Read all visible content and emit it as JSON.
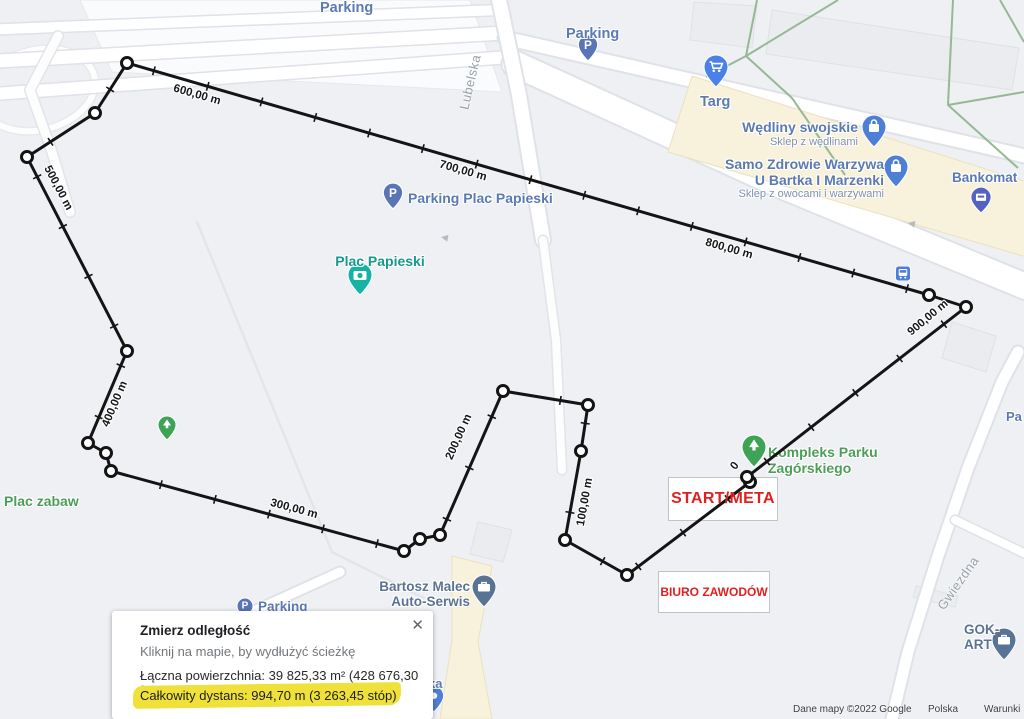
{
  "map": {
    "street_labels": [
      {
        "text": "Lubelska"
      },
      {
        "text": "Gwiezdna"
      },
      {
        "text": "Pa"
      }
    ],
    "places": [
      {
        "lines": [
          "Parking"
        ],
        "type": "parking-area"
      },
      {
        "lines": [
          "Parking"
        ],
        "type": "parking"
      },
      {
        "lines": [
          "Targ"
        ],
        "type": "market"
      },
      {
        "lines": [
          "Wędliny swojskie"
        ],
        "subtitle": "Sklep z wędlinami",
        "type": "shop"
      },
      {
        "lines": [
          "Samo Zdrowie Warzywa",
          "U Bartka I Marzenki"
        ],
        "subtitle": "Sklep z owocami i warzywami",
        "type": "shop"
      },
      {
        "lines": [
          "Bankomat"
        ],
        "type": "atm"
      },
      {
        "lines": [
          "Parking Plac Papieski"
        ],
        "type": "parking"
      },
      {
        "lines": [
          "Plac Papieski"
        ],
        "type": "attraction"
      },
      {
        "lines": [
          "Kompleks Parku",
          "Zagórskiego"
        ],
        "type": "park"
      },
      {
        "lines": [
          "Plac zabaw"
        ],
        "type": "park"
      },
      {
        "lines": [
          "Bartosz Malec",
          "Auto-Serwis"
        ],
        "type": "business"
      },
      {
        "lines": [
          "Parking"
        ],
        "type": "parking"
      },
      {
        "lines": [
          "GOK-ART"
        ],
        "type": "business"
      },
      {
        "lines": [
          "ka"
        ],
        "type": "partial-label"
      }
    ]
  },
  "route": {
    "markers": [
      "0",
      "100,00 m",
      "200,00 m",
      "300,00 m",
      "400,00 m",
      "500,00 m",
      "600,00 m",
      "700,00 m",
      "800,00 m",
      "900,00 m"
    ]
  },
  "overlays": {
    "start_meta": "START/META",
    "race_office": "BIURO ZAWODÓW"
  },
  "measure_panel": {
    "title": "Zmierz odległość",
    "hint": "Kliknij na mapie, by wydłużyć ścieżkę",
    "area_line": "Łączna powierzchnia: 39 825,33 m² (428 676,30 ft²)",
    "total_line": "Całkowity dystans: 994,70 m (3 263,45 stóp)",
    "close": "✕"
  },
  "attribution": {
    "map_data": "Dane mapy ©2022 Google",
    "country": "Polska",
    "terms": "Warunki"
  },
  "colors": {
    "route": "#141414",
    "accent_red": "#e01f1f",
    "highlight_yellow": "#efe139",
    "label_blue": "#5b7ab2",
    "label_green": "#4c9e57",
    "label_teal": "#18988b"
  }
}
